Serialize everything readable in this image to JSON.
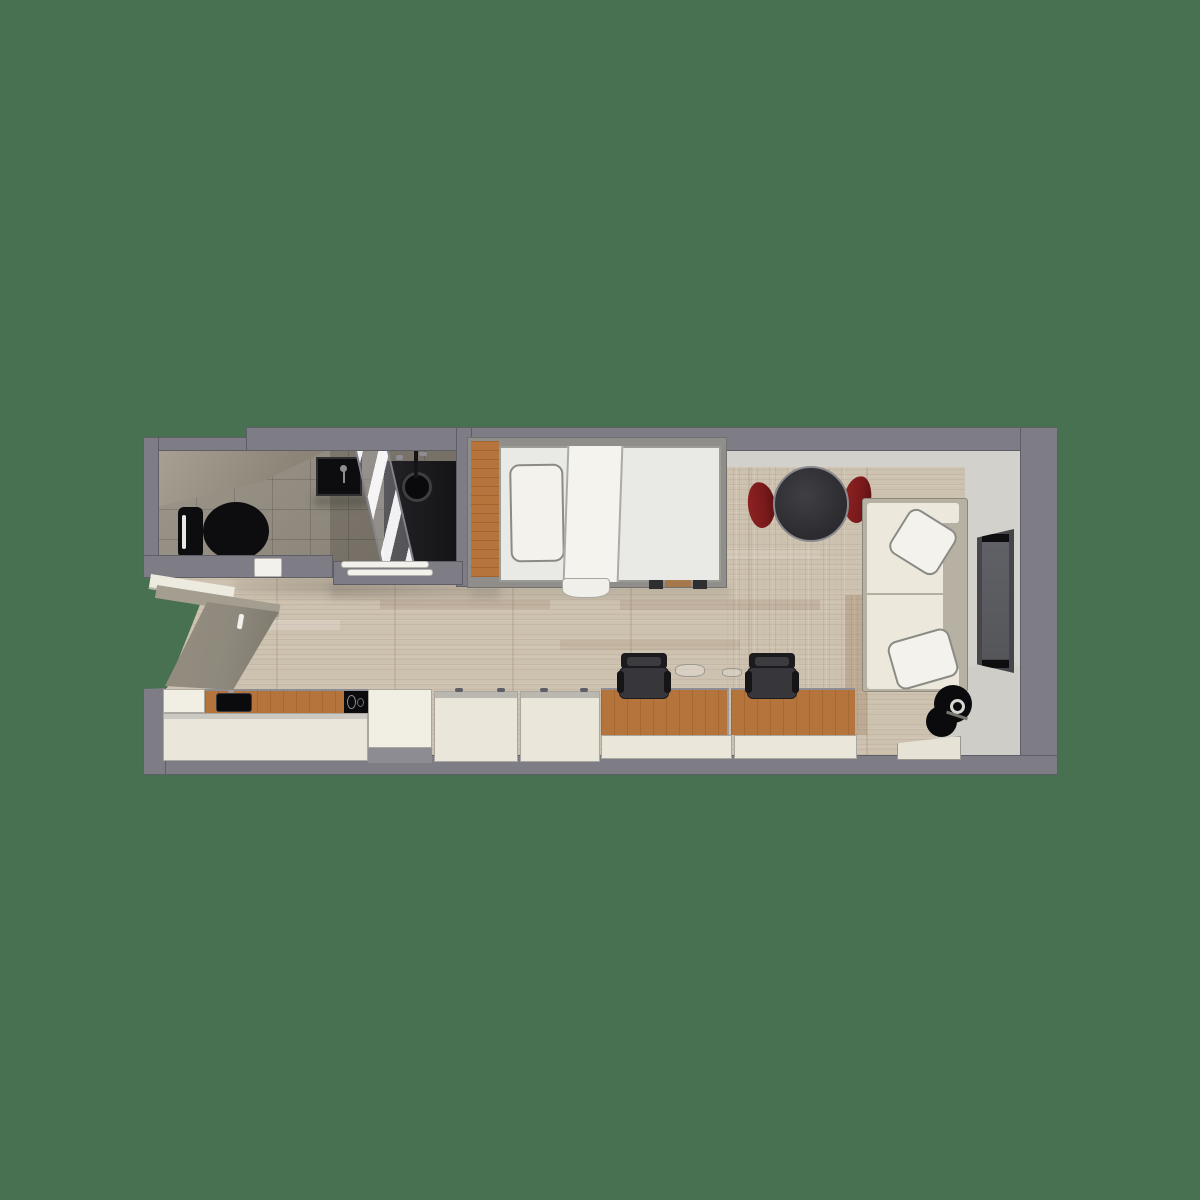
{
  "scene": {
    "title": "studio-apartment-floor-plan",
    "view": "top-down-3d-render",
    "text_content": "none"
  },
  "palette": {
    "bg": "#477150",
    "wall": "#7E7C84",
    "wallFace": "#D3D1CB",
    "floor": "#CDC1AF",
    "bathFloor": "#948D80",
    "fixture": "#0D0D0F",
    "wood": "#B4743B",
    "cream": "#EAE6D9",
    "creamBright": "#F1EEE4",
    "sofaBack": "#B7B1A4",
    "sofaSeat": "#ECE8DB",
    "table": "#2C2B2F",
    "chairRed": "#7A1A1B",
    "chairDark": "#37363B",
    "tvFrame": "#45454A",
    "tvScreen": "#55565A",
    "door": "#8E897C",
    "mat": "#8D8C92"
  },
  "elements": {
    "walls": [
      "top-wall",
      "right-wall",
      "bottom-wall",
      "left-wall-upper",
      "left-wall-lower",
      "bathroom-divider-wall",
      "bathroom-bottom-wall"
    ],
    "bathroom": [
      "bathroom-floor",
      "ceiling-bulkhead",
      "toilet",
      "vanity-sink",
      "shower-floor",
      "shower-drain",
      "shower-glass-panel",
      "shower-thresholds",
      "bathroom-door-threshold"
    ],
    "entry": [
      "entry-opening",
      "entry-door-panel",
      "door-handle"
    ],
    "sleeping": [
      "bed-frame",
      "headboard",
      "mattress",
      "pillow",
      "blanket-runner",
      "blanket-tail"
    ],
    "dining": [
      "dining-table",
      "dining-chair-left",
      "dining-chair-right"
    ],
    "living": [
      "sofa",
      "sofa-pillow-top",
      "sofa-pillow-bottom",
      "wall-tv",
      "floor-lamp",
      "platform-step"
    ],
    "work": [
      "desk-left",
      "desk-right",
      "office-chair-left",
      "office-chair-right",
      "desk-drawers-left",
      "desk-drawers-right"
    ],
    "kitchen": [
      "kitchen-counter",
      "kitchen-sink",
      "kitchen-cooktop",
      "kitchen-cabinet",
      "tall-cabinet",
      "floor-mat",
      "wardrobe-cabinet-1",
      "wardrobe-cabinet-2"
    ]
  }
}
